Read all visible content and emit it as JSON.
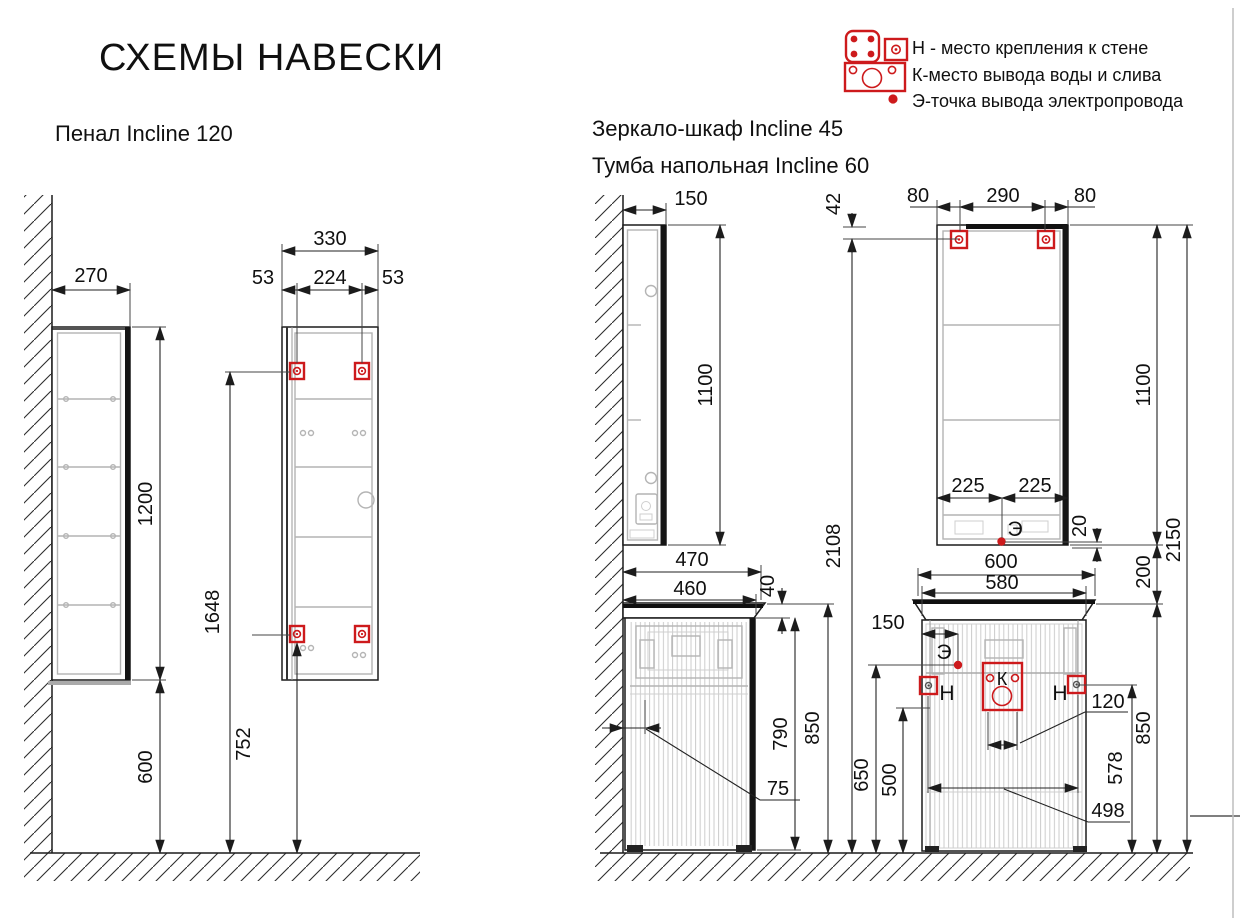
{
  "page": {
    "title": "СХЕМЫ НАВЕСКИ",
    "accent_red": "#cd1a1c",
    "line_color": "#1c1c1c",
    "detail_gray": "#b4b4b4"
  },
  "legend": {
    "items": [
      {
        "icon": "wall-mount-icons",
        "label": "Н - место крепления к стене"
      },
      {
        "icon": "water-drain-icon",
        "label": "К-место вывода воды и слива"
      },
      {
        "icon": "electric-point-icon",
        "label": "Э-точка вывода электропровода"
      }
    ]
  },
  "penal": {
    "title": "Пенал Incline 120",
    "dims": {
      "depth": "270",
      "height": "1200",
      "width": "330",
      "mount_left": "53",
      "mount_span": "224",
      "mount_right": "53",
      "top_mount_height": "1648",
      "bottom_mount_height": "752",
      "clearance": "600"
    }
  },
  "mirror": {
    "title": "Зеркало-шкаф Incline 45",
    "dims": {
      "depth": "150",
      "height": "1100",
      "mount_left": "80",
      "mount_span": "290",
      "mount_right": "80",
      "mount_from_top": "42",
      "mount_height": "2108",
      "top_height": "2150",
      "el_left": "225",
      "el_right": "225",
      "el_offset": "20"
    },
    "markers": {
      "e": "Э"
    }
  },
  "tumba": {
    "title": "Тумба напольная Incline 60",
    "dims": {
      "counter_depth": "470",
      "body_depth": "460",
      "counter_thickness": "40",
      "body_height": "790",
      "total_height": "850",
      "wall_gap": "75",
      "counter_width": "600",
      "body_width": "580",
      "mirror_gap": "200",
      "el_offset": "150",
      "el_height": "650",
      "mount_height": "500",
      "drain_width": "120",
      "drain_height": "578",
      "mount_span": "498"
    },
    "markers": {
      "e": "Э",
      "k": "К",
      "n_left": "Н",
      "n_right": "Н"
    }
  }
}
